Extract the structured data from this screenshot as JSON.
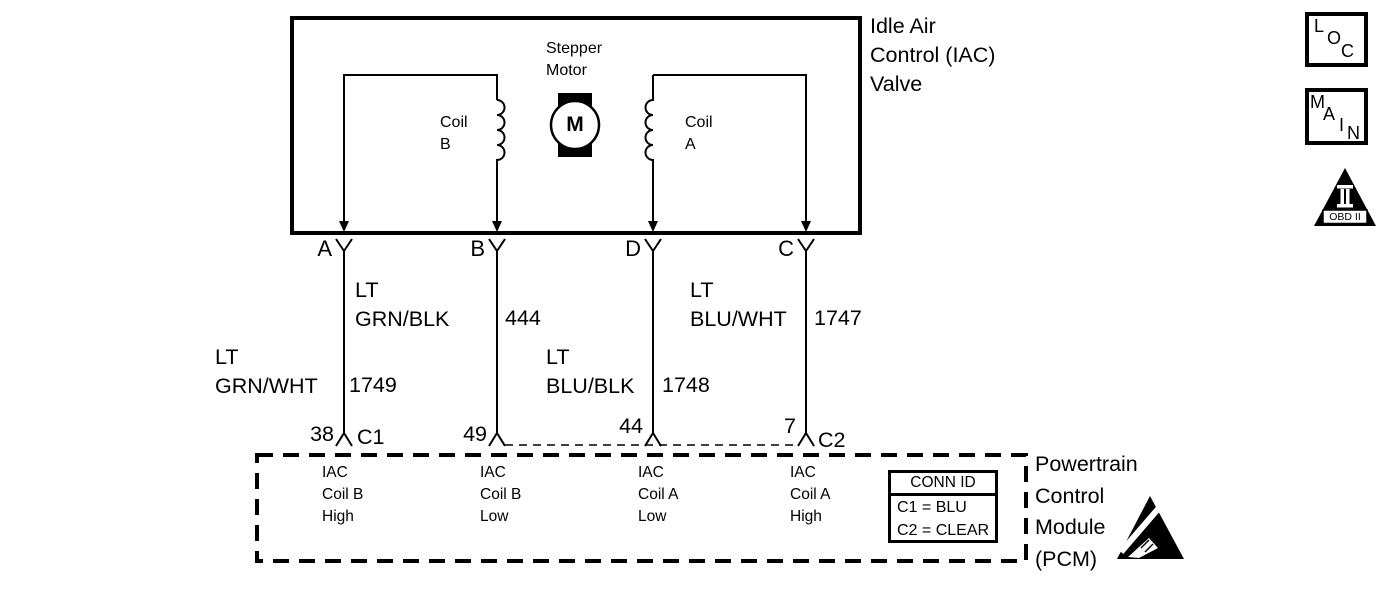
{
  "diagram": {
    "title_blocks": {
      "iac_valve_label": "Idle Air\nControl (IAC)\nValve",
      "pcm_label": "Powertrain\nControl\nModule\n(PCM)"
    },
    "iac_valve": {
      "stepper_motor_label": "Stepper\nMotor",
      "motor_symbol": "M",
      "coil_b_label": "Coil\nB",
      "coil_a_label": "Coil\nA"
    },
    "wires": [
      {
        "terminal": "A",
        "color": "LT\nGRN/WHT",
        "circuit": "1749",
        "pin": "38",
        "connector": "C1",
        "pcm_function": "IAC\nCoil B\nHigh"
      },
      {
        "terminal": "B",
        "color": "LT\nGRN/BLK",
        "circuit": "444",
        "pin": "49",
        "connector": "",
        "pcm_function": "IAC\nCoil B\nLow"
      },
      {
        "terminal": "D",
        "color": "LT\nBLU/BLK",
        "circuit": "1748",
        "pin": "44",
        "connector": "",
        "pcm_function": "IAC\nCoil A\nLow"
      },
      {
        "terminal": "C",
        "color": "LT\nBLU/WHT",
        "circuit": "1747",
        "pin": "7",
        "connector": "C2",
        "pcm_function": "IAC\nCoil A\nHigh"
      }
    ],
    "conn_id_table": {
      "title": "CONN ID",
      "rows": [
        "C1 = BLU",
        "C2 = CLEAR"
      ]
    },
    "legend": {
      "loc_letters": [
        "L",
        "O",
        "C"
      ],
      "main_letters": [
        "M",
        "A",
        "I",
        "N"
      ],
      "obd_label": "OBD II"
    },
    "colors": {
      "ink": "#000000",
      "paper": "#ffffff"
    }
  }
}
